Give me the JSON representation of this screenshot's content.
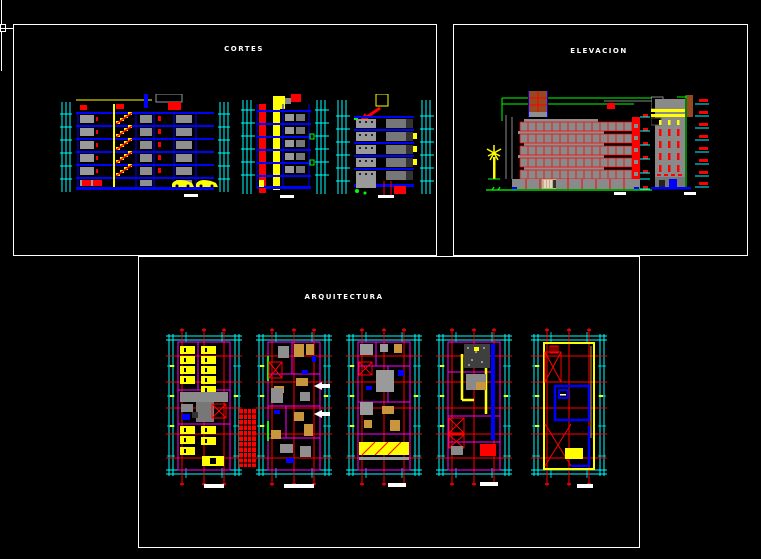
{
  "window": {
    "width": 761,
    "height": 559,
    "background": "#000000"
  },
  "sheets": {
    "cortes": {
      "title": "CORTES",
      "content": "building cross sections",
      "drawing_count": 3
    },
    "elevacion": {
      "title": "ELEVACION",
      "content": "building elevations",
      "drawing_count": 2
    },
    "arquitectura": {
      "title": "ARQUITECTURA",
      "content": "floor plans",
      "drawing_count": 5
    }
  },
  "palette": {
    "sheet_border": "#ffffff",
    "dimension_cyan": "#00ffff",
    "axis_red": "#ff0000",
    "stair_car_yellow": "#ffff00",
    "slab_blue": "#0000ff",
    "wall_magenta": "#ff00ff",
    "vegetation_green": "#00ff00",
    "concrete_gray": "#8a8a8a",
    "wood_brown": "#96491e",
    "furniture_tan": "#c8963c",
    "scalebar_white": "#ffffff"
  }
}
